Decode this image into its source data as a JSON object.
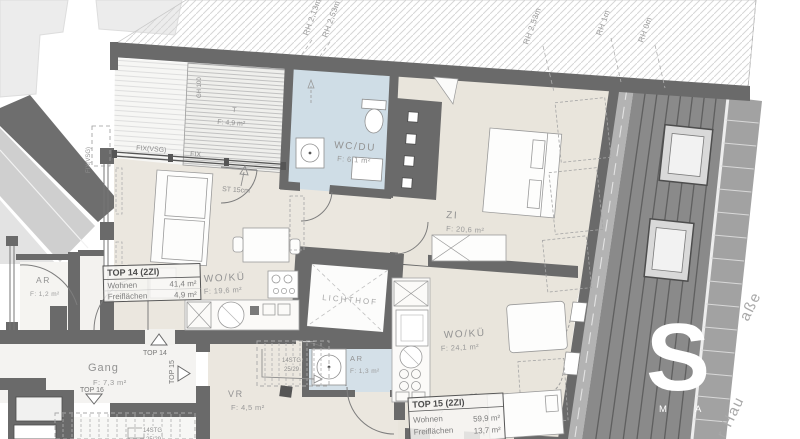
{
  "colors": {
    "wall": "#6a6a6a",
    "floor": "#eae6dd",
    "wet_room": "#cfdde6",
    "roof": "#8a8a8a",
    "hatch_line": "#d6d6d6",
    "label_gray": "#8f8f8f",
    "watermark": "#ffffff"
  },
  "elevation_marks": [
    {
      "label": "RH 2,13m"
    },
    {
      "label": "RH 2,53m"
    },
    {
      "label": "RH 2,53m"
    },
    {
      "label": "RH 1m"
    },
    {
      "label": "RH 0m"
    }
  ],
  "terrace": {
    "name": "T",
    "area": "F: 4,9 m²",
    "glass_height": "GH 100",
    "fix_label_top": "FIX(VSG)",
    "fix_label_mid": "FIX",
    "fix_label_left": "FIX(VSG)",
    "step_label": "ST 15cm"
  },
  "rooms": {
    "wc": {
      "name": "WC/DU",
      "area": "F: 6,1 m²"
    },
    "zi": {
      "name": "ZI",
      "area": "F: 20,6 m²"
    },
    "ar_top14": {
      "name": "AR",
      "area": "F: 1,2 m²"
    },
    "wo_ku_top14": {
      "name": "WO/KÜ",
      "area": "F: 19,6 m²"
    },
    "lichthof": {
      "name": "LICHTHOF"
    },
    "ar_top15": {
      "name": "AR",
      "area": "F: 1,3 m²"
    },
    "gang": {
      "name": "Gang",
      "area": "F: 7,3 m²"
    },
    "vr": {
      "name": "VR",
      "area": "F: 4,5 m²"
    },
    "wo_ku_top15": {
      "name": "WO/KÜ",
      "area": "F: 24,1 m²"
    }
  },
  "apartments": {
    "top14": {
      "title": "TOP 14 (2ZI)",
      "rows": [
        {
          "label": "Wohnen",
          "value": "41,4 m²"
        },
        {
          "label": "Freiflächen",
          "value": "4,9 m²"
        }
      ]
    },
    "top15": {
      "title": "TOP 15 (2ZI)",
      "rows": [
        {
          "label": "Wohnen",
          "value": "59,9 m²"
        },
        {
          "label": "Freiflächen",
          "value": "13,7 m²"
        }
      ]
    }
  },
  "entrances": {
    "top14": "TOP 14",
    "top15": "TOP 15",
    "top16": "TOP 16"
  },
  "stairs": {
    "upper": {
      "steps": "14STG",
      "ratio": "25/29"
    },
    "lower": {
      "steps": "14STG",
      "ratio": "25/29"
    }
  },
  "street": {
    "fragment_top": "aße",
    "fragment_bottom": "r Hau"
  },
  "watermark": {
    "letter": "S",
    "subtext": "M A"
  }
}
